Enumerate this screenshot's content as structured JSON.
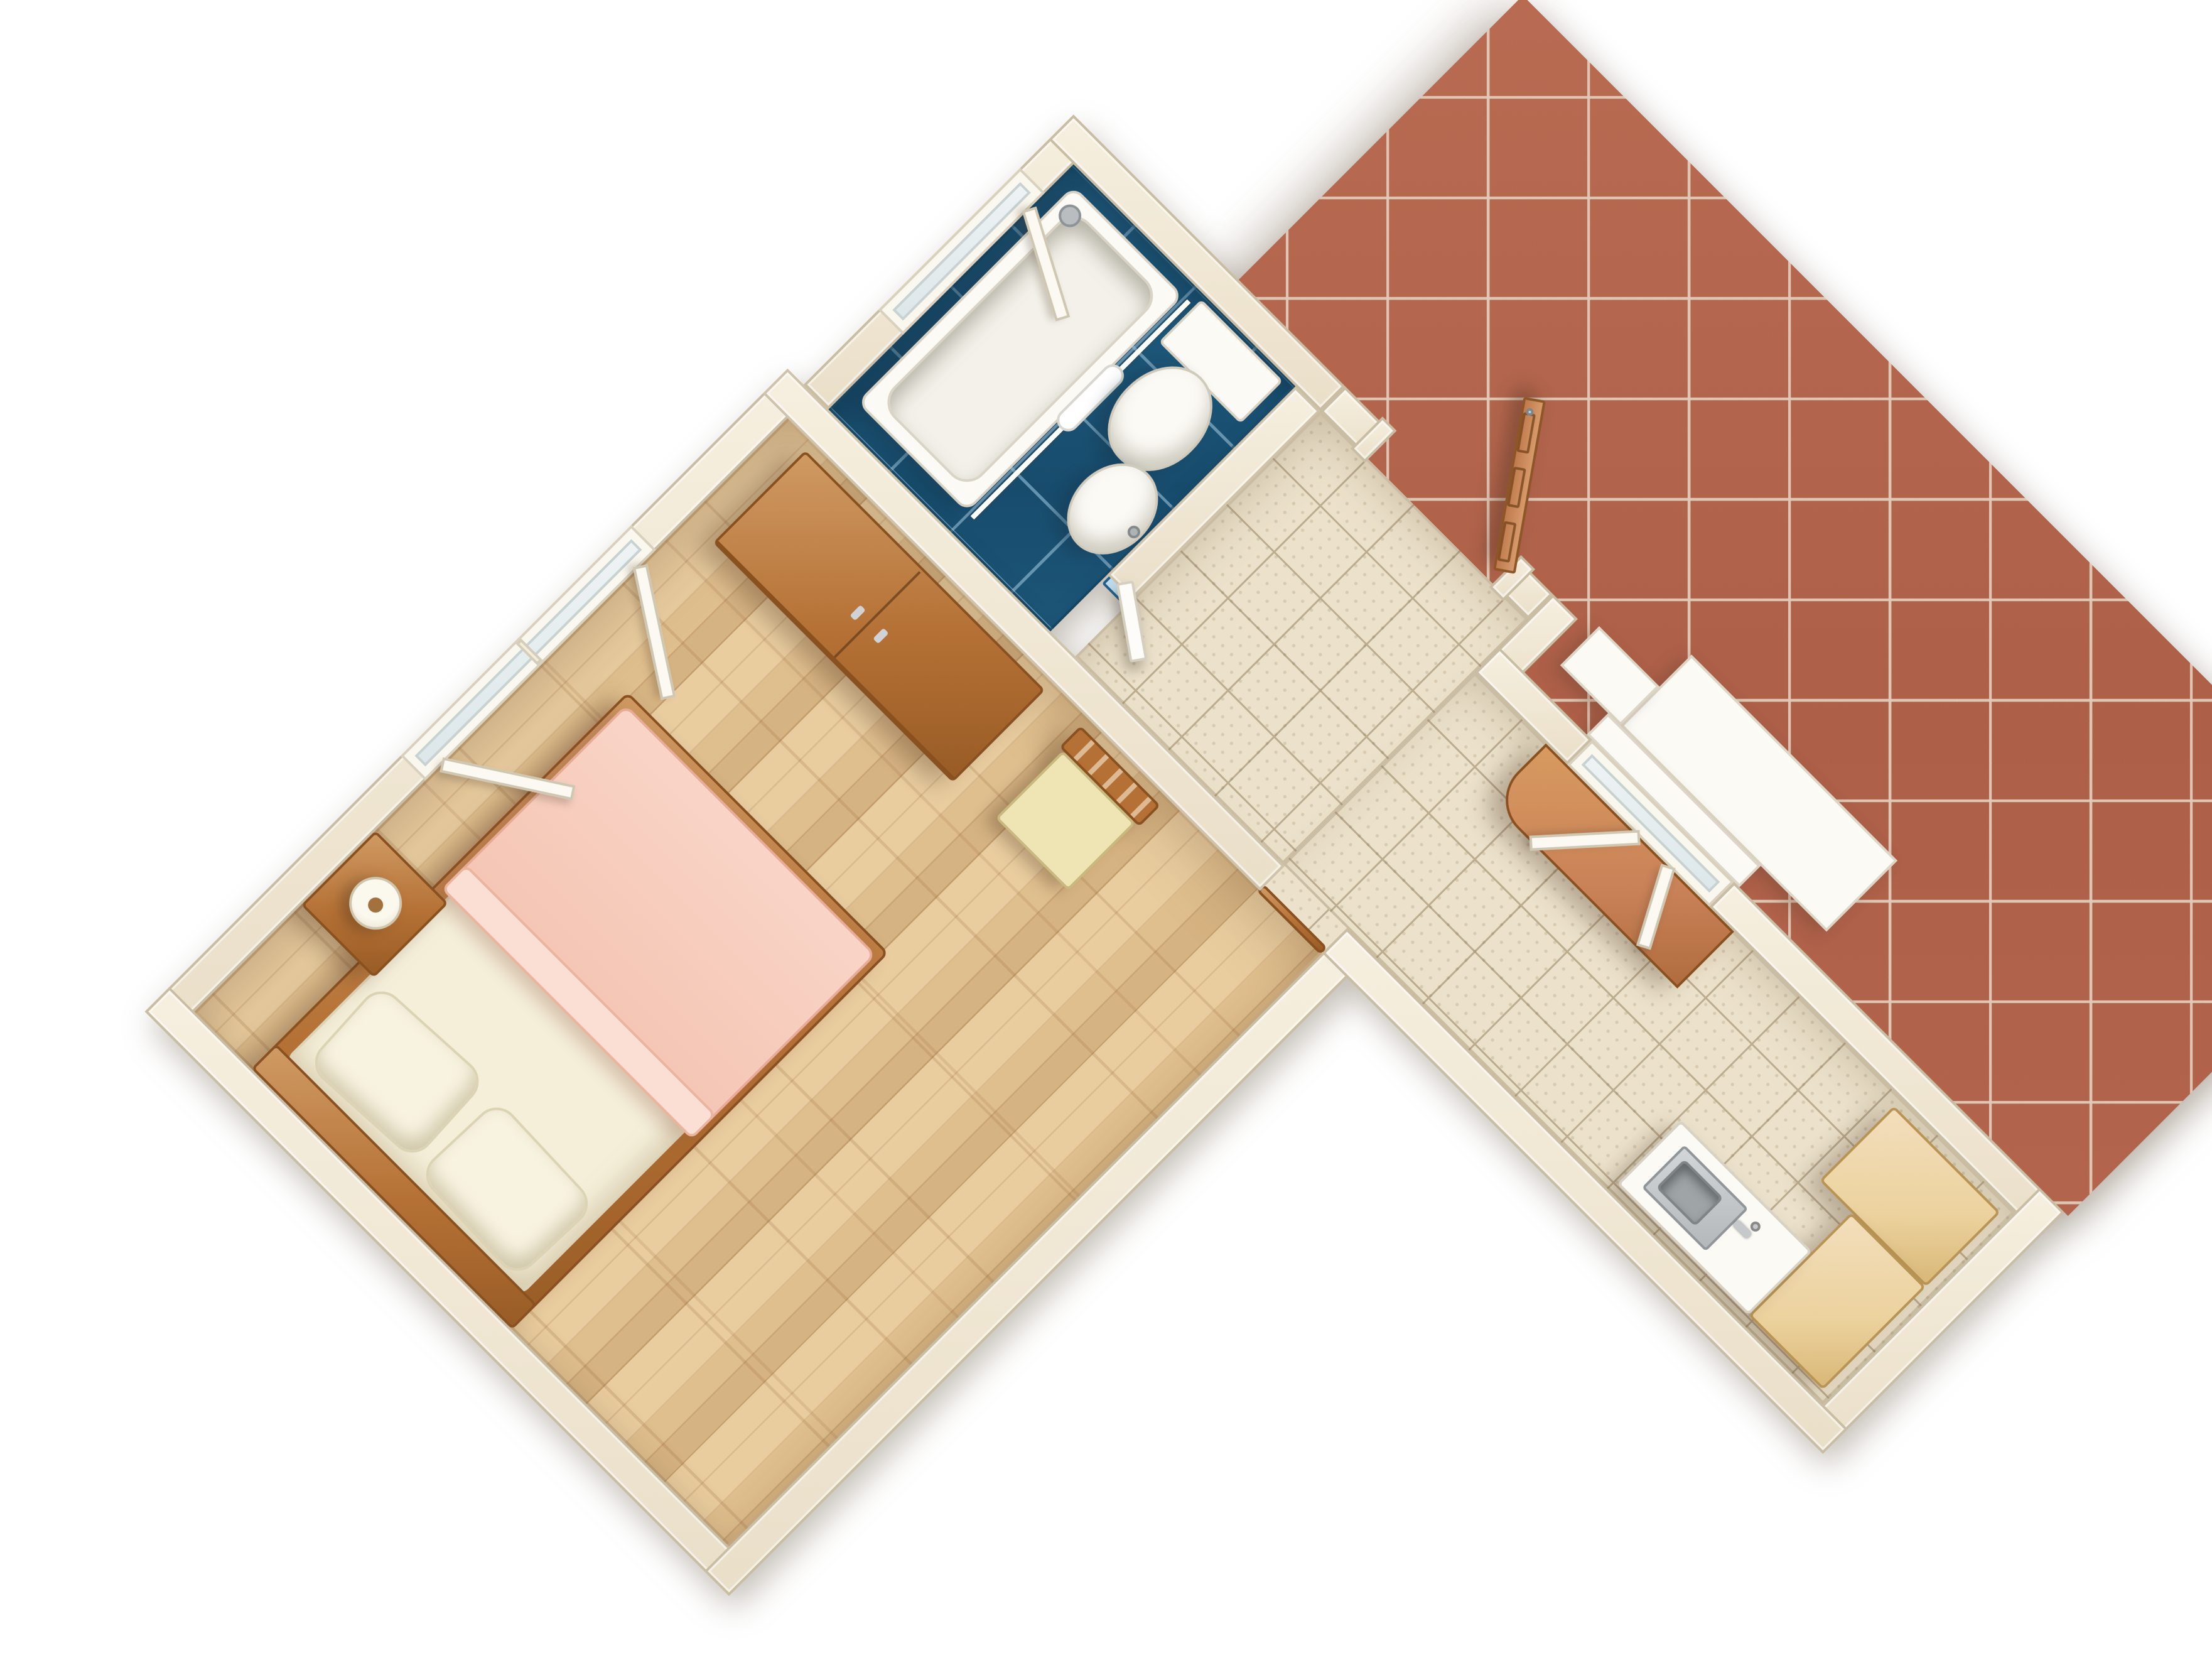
{
  "scene": {
    "title": "3D floor plan render — studio apartment with terrace",
    "view": "top-down axonometric, rotated 45 degrees",
    "background": "#ffffff"
  },
  "palette": {
    "wall": "#efe7d5",
    "wall-edge": "#cfc3ac",
    "parquet": "#e0bf8e",
    "hall-tile": "#ece2cb",
    "hall-grout": "#bcac90",
    "bath-floor": "#1d5678",
    "terrace-tile": "#b2644c",
    "terrace-grout": "#dbc9b9",
    "wood": "#b57135",
    "wood-dark": "#995c26",
    "wood-light": "#cf9a63",
    "door-wood": "#c98157",
    "beech": "#ecd29e",
    "blanket": "#f8cfc0",
    "linen": "#f5efda",
    "white-fixture": "#fbfaf5",
    "steel": "#b9bdbf",
    "mirror": "#bfdcec",
    "mirror-frame": "#1f5f8a",
    "seat": "#efe5b4"
  },
  "rooms": {
    "bedroom": {
      "label": "Bedroom",
      "floor": "oak parquet"
    },
    "bathroom": {
      "label": "Bathroom",
      "floor": "blue ceramic tile"
    },
    "hallway": {
      "label": "Entry hall",
      "floor": "beige ceramic tile"
    },
    "kitchenette": {
      "label": "Kitchenette corridor",
      "floor": "beige ceramic tile"
    },
    "terrace": {
      "label": "Terrace",
      "floor": "terracotta tile"
    }
  },
  "furniture": {
    "bedroom": [
      "Double bed",
      "Pillow",
      "Pillow",
      "Pink blanket",
      "Headboard",
      "Nightstand",
      "Table lamp",
      "Wardrobe",
      "Chair",
      "Bedroom window"
    ],
    "bathroom": [
      "Bathtub",
      "Shower head",
      "Shower curtain rail",
      "Shower curtain",
      "Toilet",
      "Cistern shelf",
      "Washbasin",
      "Wall mirror",
      "Bathroom window",
      "Bathroom door"
    ],
    "hallway": [
      "Entry door",
      "Door frame",
      "Threshold"
    ],
    "kitchenette": [
      "Console desk",
      "Kitchen window",
      "Kitchen sink",
      "Sink faucet",
      "Kitchen counter",
      "Beech cabinet",
      "Beech cabinet"
    ],
    "terrace": [
      "Terrace ledge",
      "Terrace ledge small",
      "Window sill"
    ]
  }
}
